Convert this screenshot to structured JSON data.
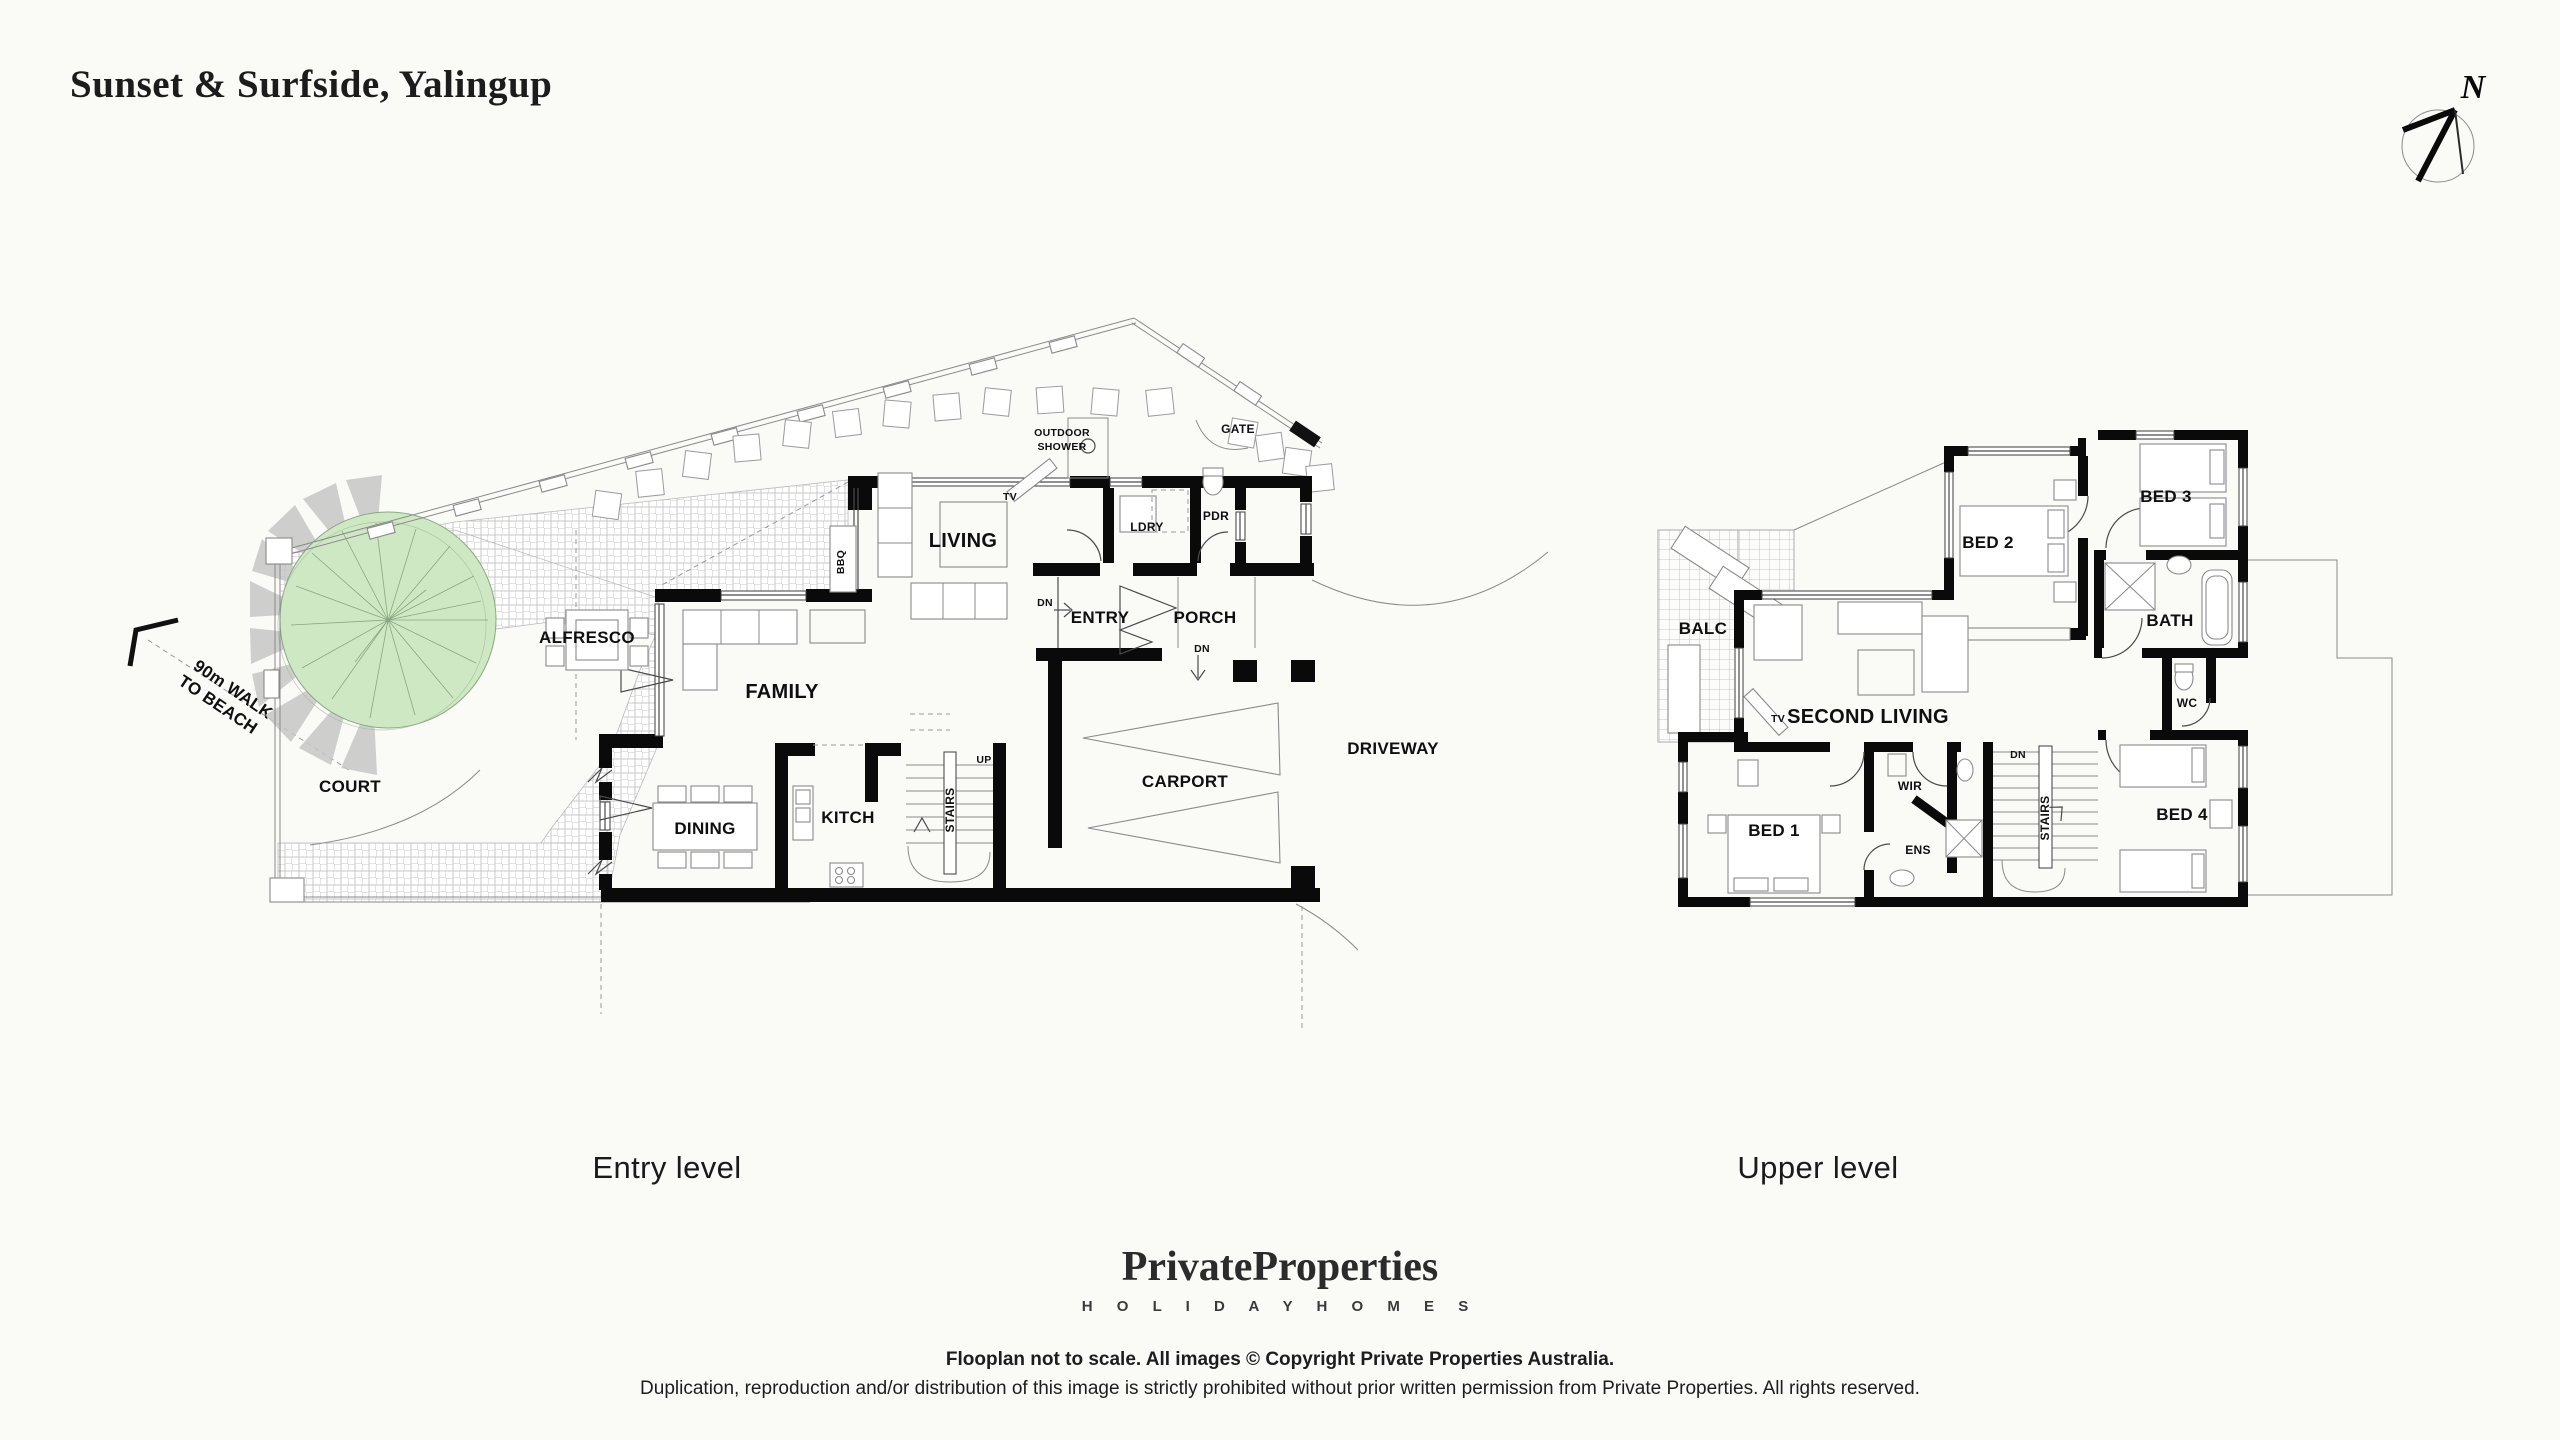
{
  "title": "Sunset & Surfside, Yalingup",
  "compass": {
    "north_label": "N"
  },
  "beach_note": {
    "line1": "90m WALK",
    "line2": "TO BEACH"
  },
  "entry_level": {
    "caption": "Entry level",
    "rooms": {
      "court": "COURT",
      "alfresco": "ALFRESCO",
      "family": "FAMILY",
      "dining": "DINING",
      "kitchen": "KITCH",
      "stairs": "STAIRS",
      "living": "LIVING",
      "laundry": "LDRY",
      "powder": "PDR",
      "entry": "ENTRY",
      "porch": "PORCH",
      "carport": "CARPORT",
      "driveway": "DRIVEWAY"
    },
    "annotations": {
      "outdoor_shower_line1": "OUTDOOR",
      "outdoor_shower_line2": "SHOWER",
      "gate": "GATE",
      "bbq": "BBQ",
      "tv": "TV",
      "up": "UP",
      "dn": "DN"
    }
  },
  "upper_level": {
    "caption": "Upper level",
    "rooms": {
      "balcony": "BALC",
      "bed1": "BED 1",
      "bed2": "BED 2",
      "bed3": "BED 3",
      "bed4": "BED 4",
      "second_living": "SECOND LIVING",
      "wir": "WIR",
      "ensuite": "ENS",
      "stairs": "STAIRS",
      "bath": "BATH",
      "wc": "WC"
    },
    "annotations": {
      "tv": "TV",
      "dn": "DN"
    }
  },
  "footer": {
    "brand": "PrivateProperties",
    "brand_tagline": "H O L I D A Y   H O M E S",
    "note_line1": "Flooplan not to scale. All images © Copyright Private Properties Australia.",
    "note_line2": "Duplication, reproduction and/or distribution of this image is strictly prohibited without prior written permission from Private Properties. All rights reserved."
  },
  "colors": {
    "background": "#fafaf7",
    "wall": "#0a0a0a",
    "tree_green": "#cfe8c4",
    "shadow_grey": "#c6c6c6"
  }
}
